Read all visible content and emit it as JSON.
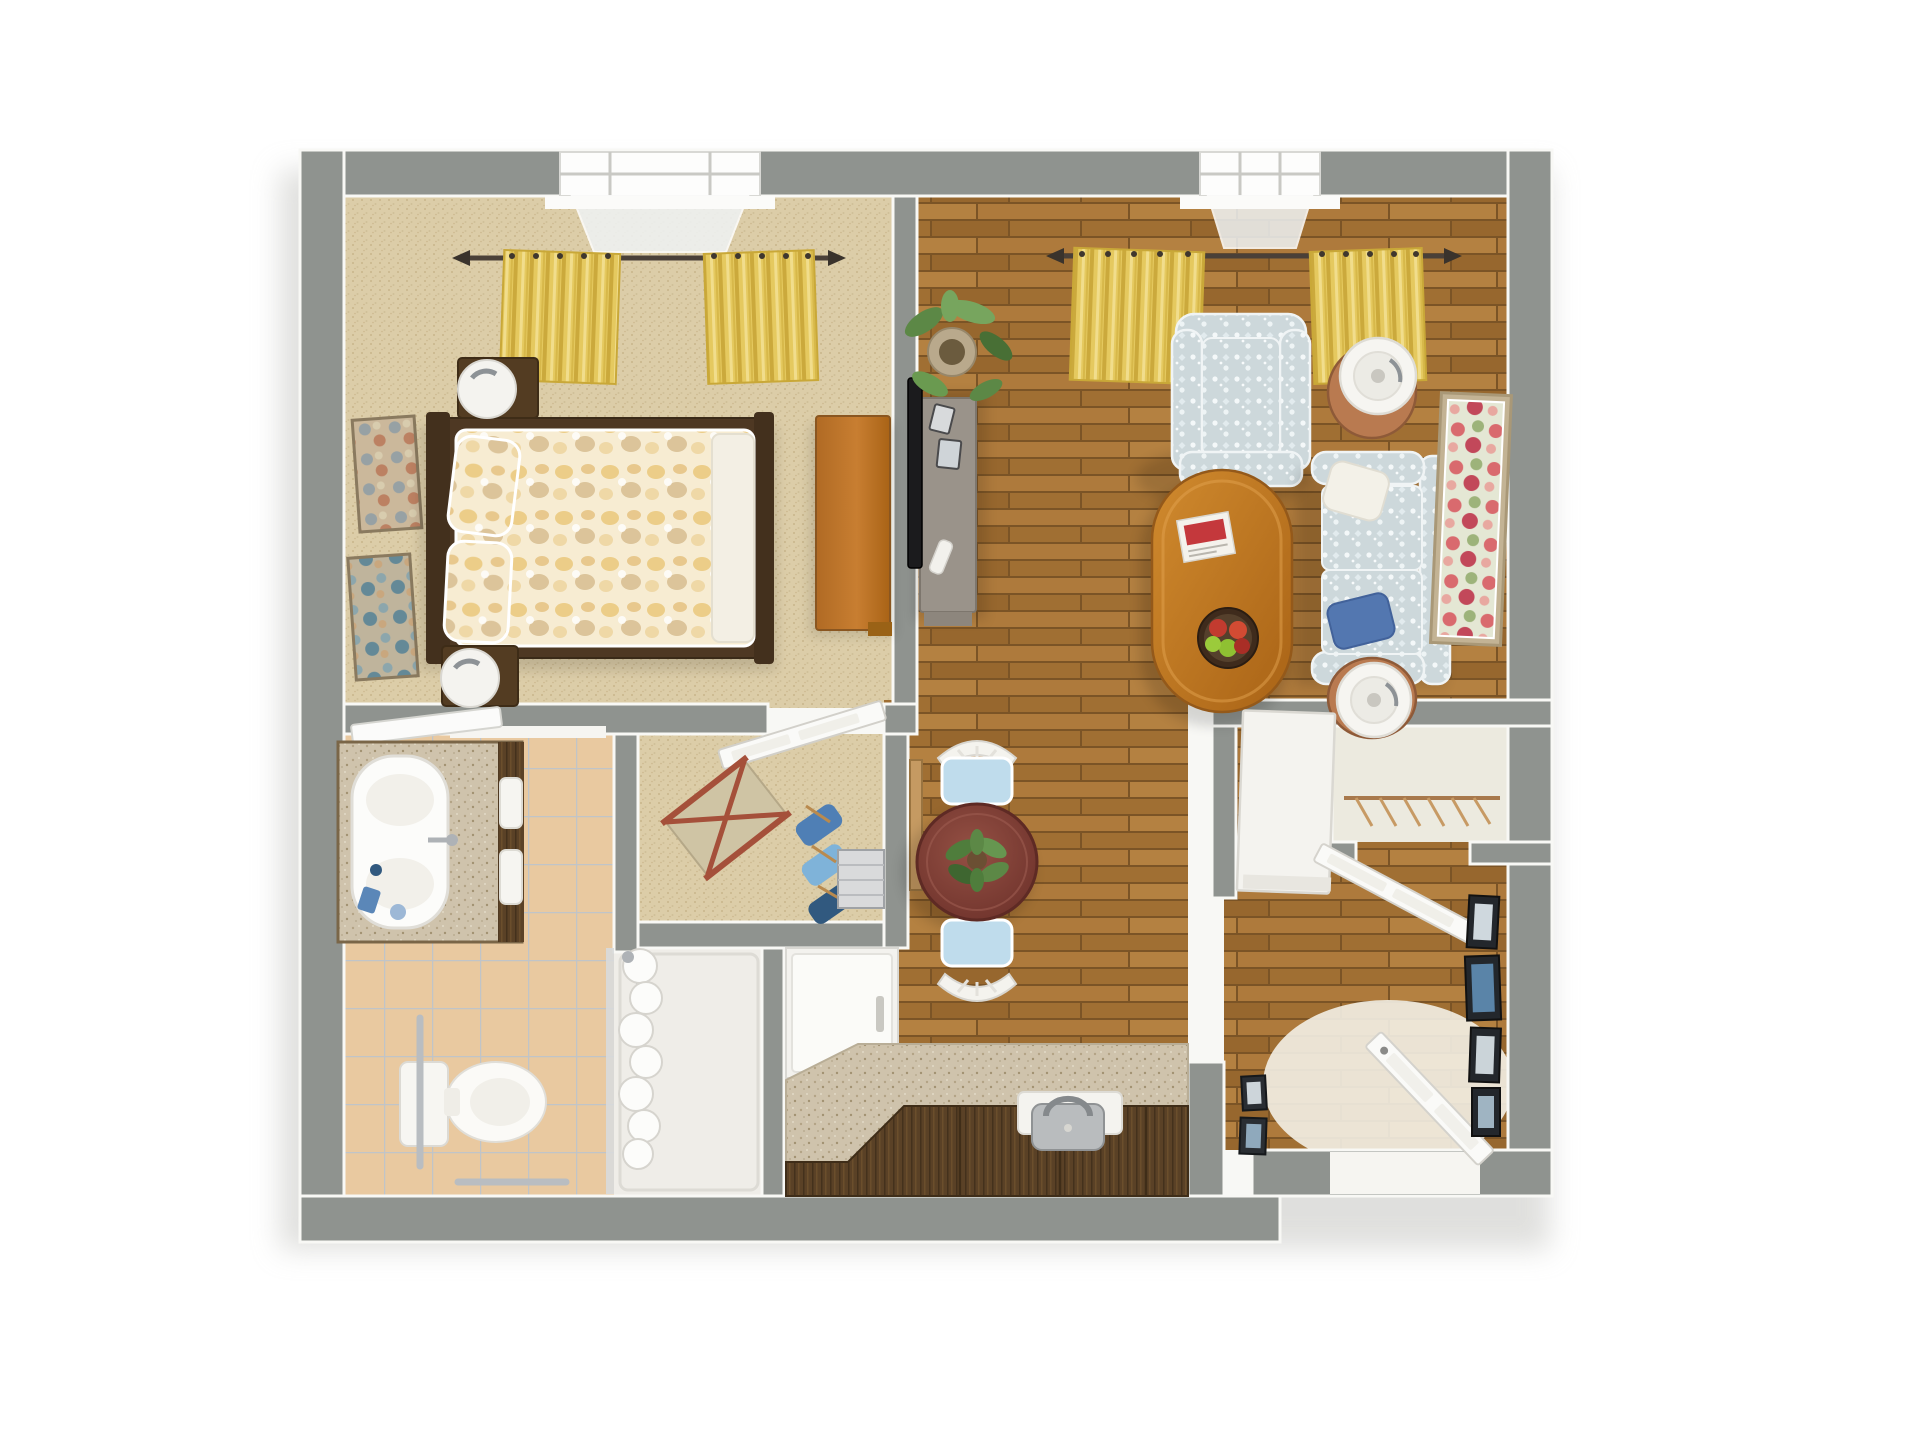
{
  "scene": {
    "type": "3d-floor-plan",
    "description": "Top-down 3D rendering of a one-bedroom apartment with living room, dining area, kitchen, bathroom, walk-in closet and entry",
    "rooms": [
      {
        "name": "Bedroom",
        "floor": "beige carpet",
        "items": [
          "bed with yellow floral bedding",
          "dark wood bed frame",
          "two nightstands",
          "two white sphere lamps",
          "wood dresser",
          "two wall art canvases",
          "window with yellow curtains",
          "white interior door"
        ]
      },
      {
        "name": "Living Room",
        "floor": "hardwood planks",
        "items": [
          "patterned armchair",
          "patterned loveseat sofa",
          "white throw pillow",
          "blue throw pillow",
          "oval wood coffee table",
          "magazine",
          "fruit bowl",
          "two round end tables",
          "two white drum floor lamps",
          "media console",
          "flat screen tv",
          "remote control",
          "photo frames",
          "potted plant",
          "framed floral painting",
          "window with yellow curtains"
        ]
      },
      {
        "name": "Dining Area",
        "floor": "hardwood planks",
        "items": [
          "round dark wood dining table",
          "plant centerpiece",
          "two white chairs with blue cushions",
          "narrow wall shelf"
        ]
      },
      {
        "name": "Kitchen",
        "items": [
          "white refrigerator",
          "granite counter with diagonal corner",
          "dark wood base cabinets",
          "stainless steel sink with faucet"
        ]
      },
      {
        "name": "Bathroom",
        "floor": "tan ceramic tile",
        "items": [
          "vanity with granite top and white basin",
          "leaning mirror",
          "towels",
          "toiletries",
          "toilet",
          "grab bars",
          "walk-in shower",
          "bunched shower curtain",
          "glass partition"
        ]
      },
      {
        "name": "Walk-in Closet",
        "floor": "beige carpet",
        "items": [
          "folding valet stand",
          "hanging blue clothes",
          "wire storage rack"
        ]
      },
      {
        "name": "Hall Closet",
        "items": [
          "closet rod with wooden hangers",
          "white storage cabinet",
          "white closet door"
        ]
      },
      {
        "name": "Entry",
        "items": [
          "open white front door",
          "leaning picture frames",
          "bright doorway light"
        ]
      }
    ],
    "window_count": 2,
    "curtain_color_name": "yellow"
  },
  "palette": {
    "wall": "#8F938F",
    "walledge": "#7A7E7A",
    "trim": "#F8F8F5",
    "carpet": "#DCCDA8",
    "carpetdot": "#C8B68C",
    "wood": "#A9743A",
    "tile": "#E9C9A0",
    "tileline": "#C0C4C8",
    "granite": "#CFC3AC",
    "cabinet": "#5A4126",
    "fridge": "#F3F2EE",
    "curtain": "#E5C95F",
    "fabric": "#CDD8DB",
    "bedframe": "#4E3823",
    "cherry": "#7E3E34",
    "coffee": "#C57B22",
    "dresser": "#C0762C",
    "lamptable": "#B97A50",
    "plantgreen": "#5C8846",
    "pillowblue": "#5377B0",
    "seatblue": "#BFDCEC",
    "steel": "#B9BDC1",
    "tv": "#1B1B1D",
    "doorwhite": "#FAFAF8",
    "lightfloor": "#F3EFE5",
    "closetfloor": "#ECEADF",
    "framedark": "#23272C",
    "artpink": "#D96A6E"
  }
}
